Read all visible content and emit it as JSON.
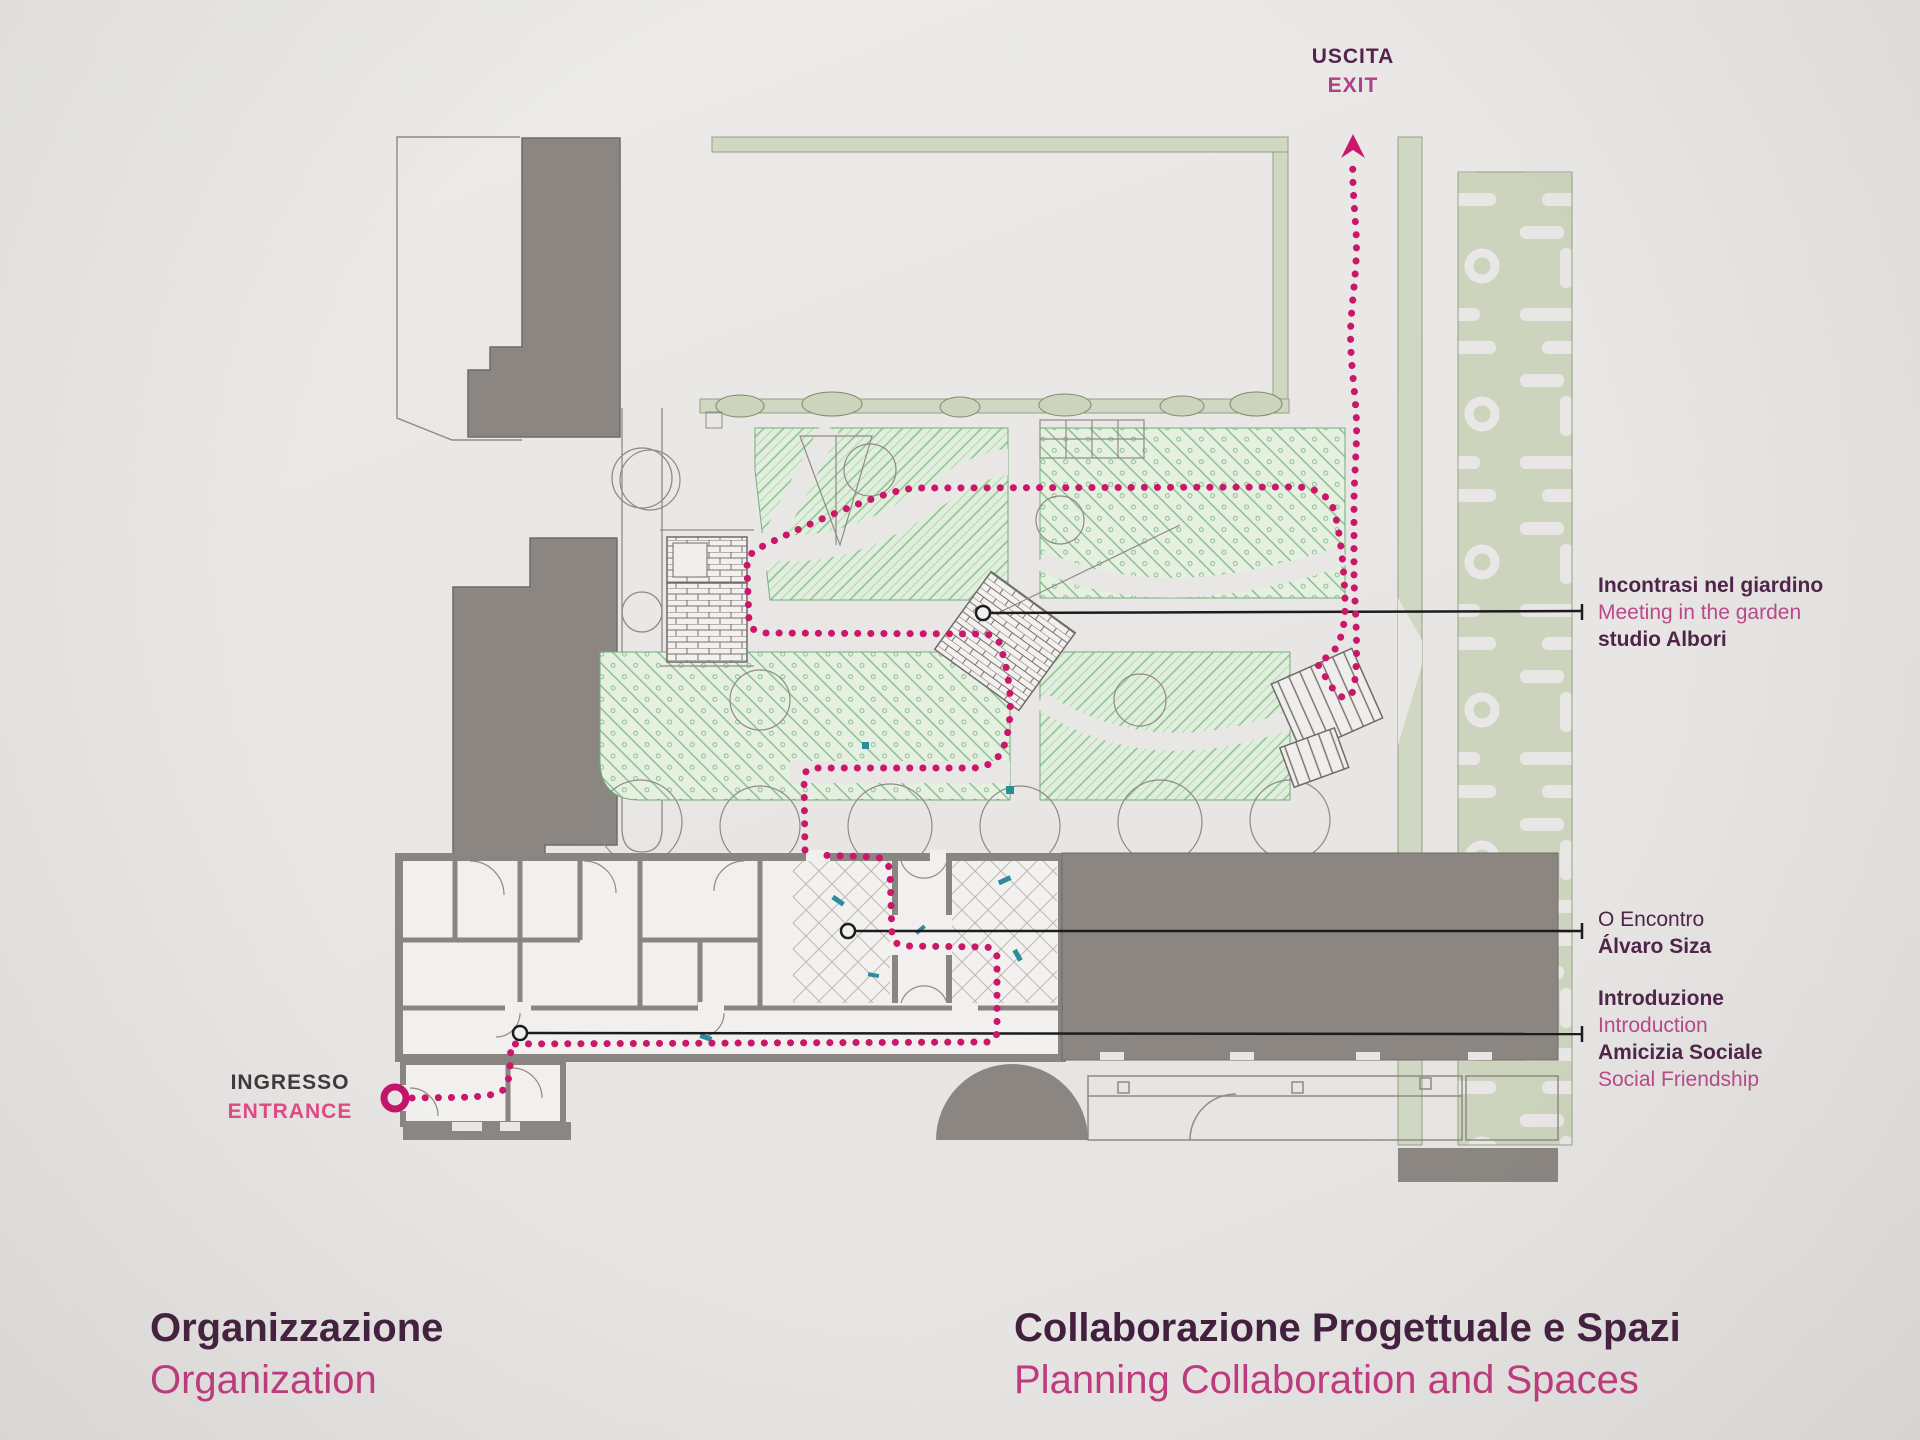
{
  "colors": {
    "paper": "#e9e7e5",
    "building_gray": "#8b8681",
    "wall_gray": "#8a8580",
    "hedge_sage": "#d0d7c2",
    "parterre_sage": "#ccd4bd",
    "garden_green": "#8cc493",
    "route_magenta": "#cb176a",
    "heading_purple": "#4f2449",
    "subtitle_magenta": "#c03a7f",
    "callout_secondary": "#b9498b",
    "entrance_text_pink": "#e24a85",
    "ingresso_text": "#3c393a",
    "callout_line_black": "#1d1c1c",
    "teal_accent": "#2d8b9e"
  },
  "markers": {
    "exit": {
      "it": "USCITA",
      "en": "EXIT"
    },
    "entrance": {
      "it": "INGRESSO",
      "en": "ENTRANCE"
    }
  },
  "callouts": [
    {
      "title_it": "Incontrasi nel giardino",
      "title_en": "Meeting in the garden",
      "author": "studio Albori"
    },
    {
      "title_it": "O Encontro",
      "author": "Álvaro Siza"
    },
    {
      "title_it": "Introduzione",
      "title_en": "Introduction",
      "title2_it": "Amicizia Sociale",
      "title2_en": "Social Friendship"
    }
  ],
  "footer": {
    "left": {
      "it": "Organizzazione",
      "en": "Organization"
    },
    "right": {
      "it": "Collaborazione Progettuale e Spazi",
      "en": "Planning Collaboration and Spaces"
    }
  }
}
